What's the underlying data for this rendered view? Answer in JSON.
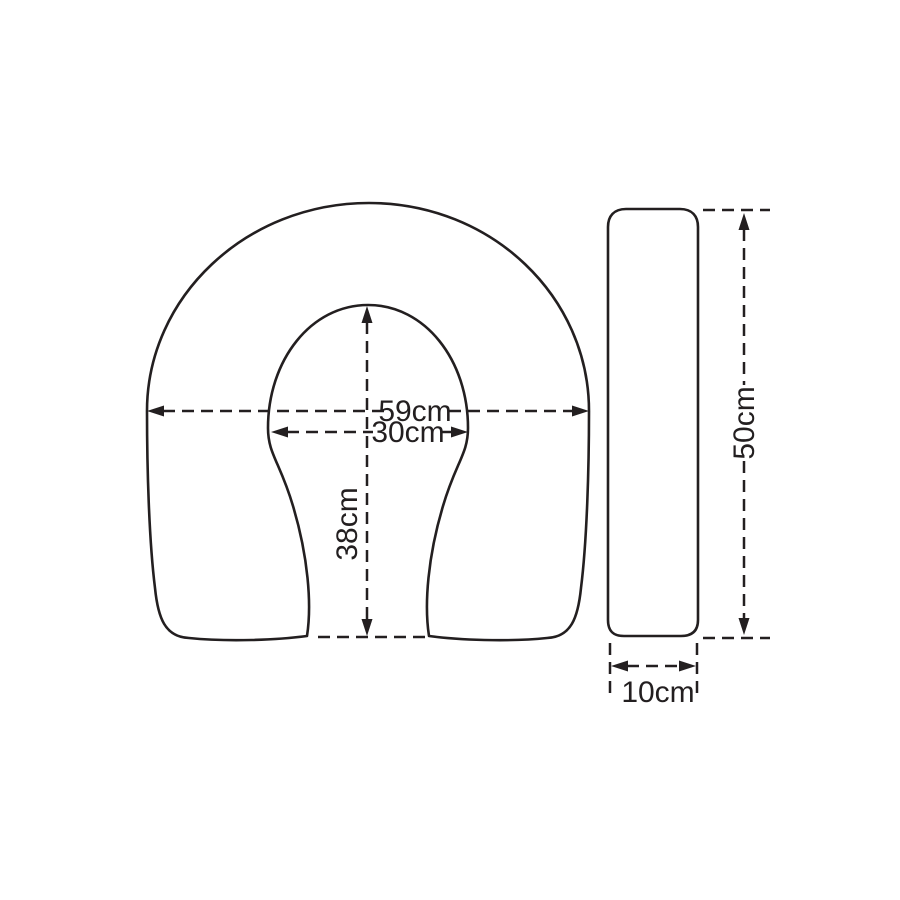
{
  "front_view": {
    "outer_width": "59cm",
    "inner_width": "30cm",
    "inner_depth": "38cm"
  },
  "side_view": {
    "height": "50cm",
    "thickness": "10cm"
  },
  "style": {
    "line_color": "#231f20",
    "background_color": "#ffffff"
  }
}
